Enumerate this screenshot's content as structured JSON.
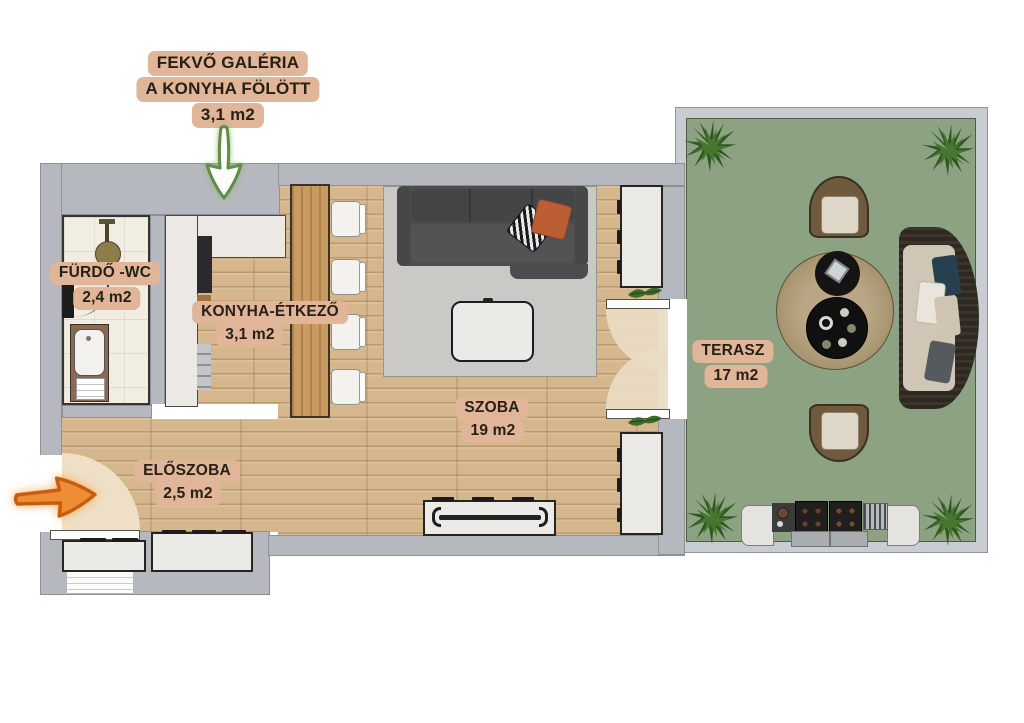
{
  "annotations": {
    "galeria": {
      "line1": "FEKVŐ GALÉRIA",
      "line2": "A KONYHA FÖLÖTT",
      "area": "3,1 m2"
    }
  },
  "rooms": {
    "furdo_wc": {
      "name": "FÜRDŐ -WC",
      "area": "2,4 m2"
    },
    "konyha_etkezo": {
      "name": "KONYHA-ÉTKEZŐ",
      "area": "3,1 m2"
    },
    "szoba": {
      "name": "SZOBA",
      "area": "19 m2"
    },
    "eloszoba": {
      "name": "ELŐSZOBA",
      "area": "2,5 m2"
    },
    "terasz": {
      "name": "TERASZ",
      "area": "17 m2"
    }
  },
  "icons": {
    "galeria_arrow": "arrow-down-icon",
    "entrance_arrow": "arrow-right-icon",
    "corner_plants": "plant-icon",
    "sill_plants": "sprig-icon"
  },
  "colors": {
    "label_bg": "#e0b598",
    "label_text": "#262017",
    "wall": "#b5b8be",
    "terrace_wall": "#c9cdd1",
    "terrace_floor": "#8da283",
    "wood_floor": "#d6b68c",
    "entry_highlight": "#eedfc6",
    "bath_floor": "#f2ede3",
    "rug": "#cac9c5",
    "sofa": "#4b4d4e",
    "arrow_green": "#628b4c",
    "arrow_orange": "#e07a20",
    "bar_wood": "#c99b61"
  }
}
